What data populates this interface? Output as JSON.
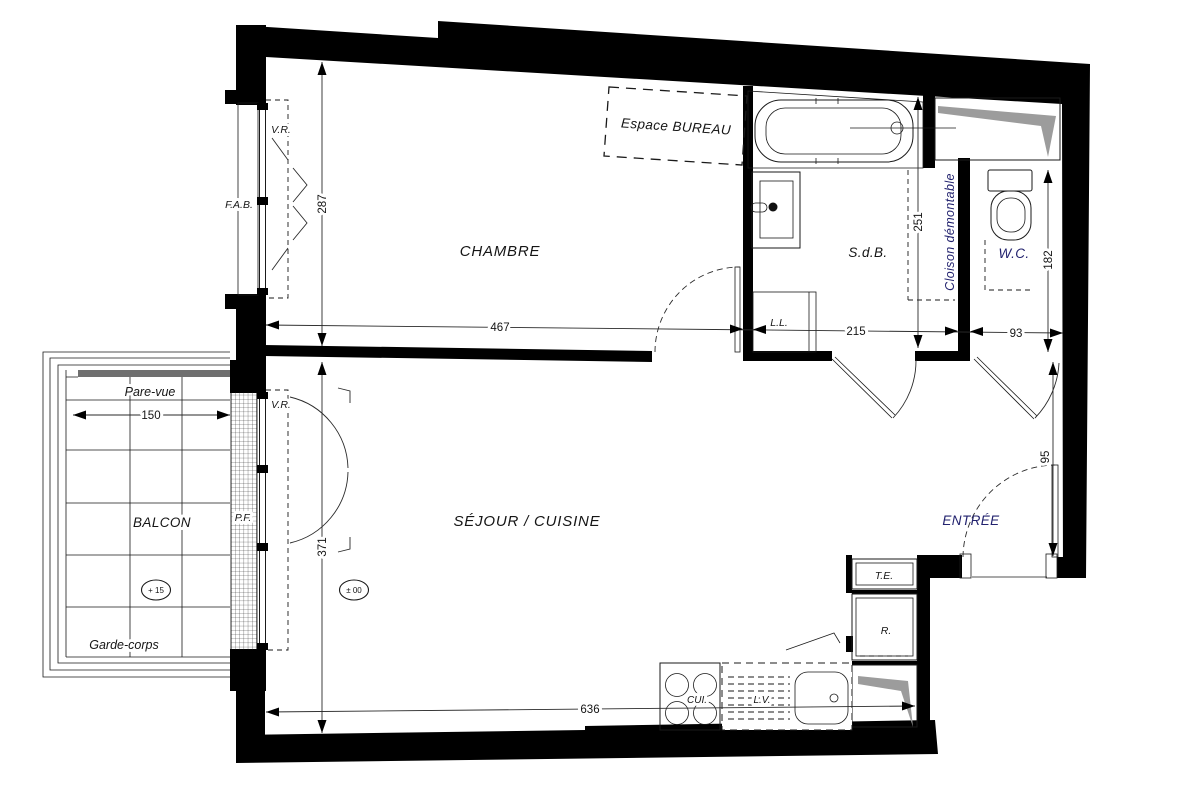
{
  "plan": {
    "rooms": {
      "chambre": "CHAMBRE",
      "sejour_cuisine": "SÉJOUR / CUISINE",
      "sdb": "S.d.B.",
      "wc": "W.C.",
      "entree": "ENTRÉE",
      "balcon": "BALCON",
      "espace_bureau": "Espace BUREAU"
    },
    "annotations": {
      "cloison_demontable": "Cloison démontable",
      "pare_vue": "Pare-vue",
      "garde_corps": "Garde-corps",
      "vr_window_chambre": "V.R.",
      "vr_porte_fenetre": "V.R.",
      "fab": "F.A.B.",
      "pf": "P.F.",
      "ll": "L.L.",
      "te": "T.E.",
      "r": "R.",
      "cui": "CUI.",
      "lv": "L.V."
    },
    "dimensions": {
      "chambre_width": "467",
      "chambre_depth": "287",
      "sdb_width": "215",
      "wc_width": "93",
      "sdb_depth": "251",
      "wc_depth": "182",
      "sejour_depth": "371",
      "sejour_width": "636",
      "balcon_width": "150",
      "porte_entree": "95"
    },
    "levels": {
      "balcon": "+ 15",
      "interieur": "± 00"
    },
    "colors": {
      "wall": "#000000",
      "line": "#1a1a1a",
      "label_navy": "#22226e",
      "shaft_gray": "#9c9c9c",
      "balcony_band": "#6f6f6f"
    }
  }
}
